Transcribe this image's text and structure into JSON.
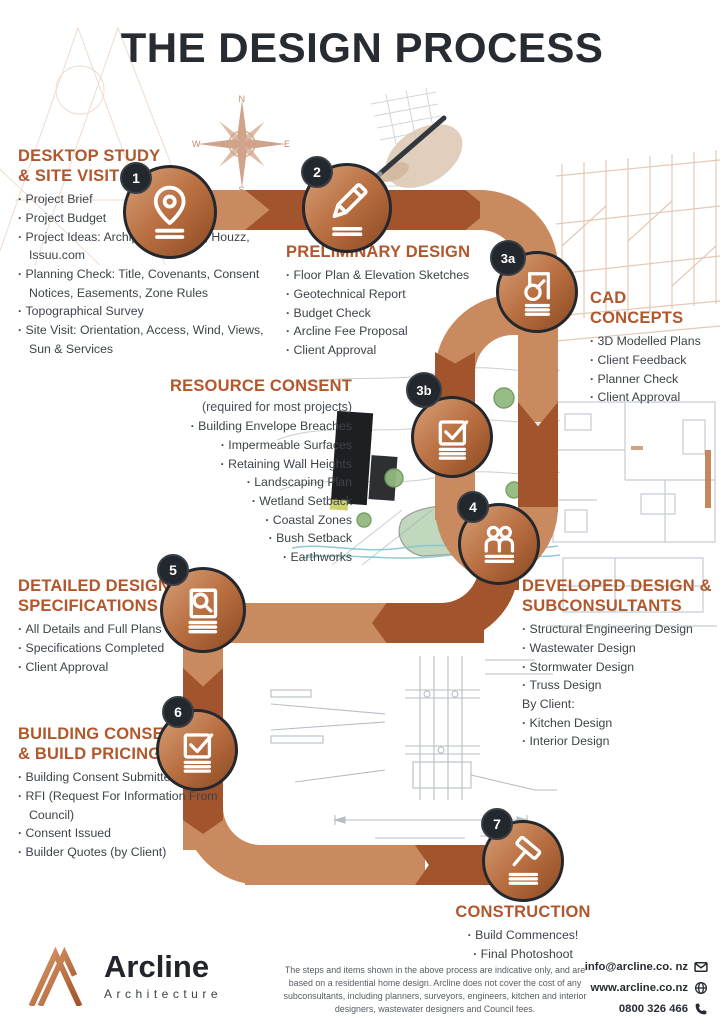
{
  "page": {
    "title": "THE DESIGN PROCESS"
  },
  "colors": {
    "accent_heading": "#b2572c",
    "path_light": "#c98a60",
    "path_dark": "#a2552c",
    "node_ring": "#23272e",
    "ink": "#272c33",
    "body_text": "#3d434b"
  },
  "compass": {
    "n": "N",
    "e": "E",
    "s": "S",
    "w": "W"
  },
  "steps": [
    {
      "number": "1",
      "icon": "location-pin-icon",
      "heading": "DESKTOP STUDY\n& SITE VISIT",
      "items": [
        "Project Brief",
        "Project Budget",
        "Project Ideas: Archipro, Pinterest, Houzz, Issuu.com",
        "Planning Check: Title, Covenants, Consent Notices, Easements, Zone Rules",
        "Topographical Survey",
        "Site Visit: Orientation, Access, Wind, Views, Sun & Services"
      ]
    },
    {
      "number": "2",
      "icon": "pencil-icon",
      "heading": "PRELIMINARY DESIGN",
      "items": [
        "Floor Plan & Elevation Sketches",
        "Geotechnical Report",
        "Budget Check",
        "Arcline Fee Proposal",
        "Client Approval"
      ]
    },
    {
      "number": "3a",
      "icon": "cad-drawing-icon",
      "heading": "CAD CONCEPTS",
      "items": [
        "3D Modelled Plans",
        "Client Feedback",
        "Planner Check",
        "Client Approval"
      ]
    },
    {
      "number": "3b",
      "icon": "checkbox-icon",
      "heading": "RESOURCE CONSENT",
      "subtitle": "(required for most projects)",
      "items": [
        "Building Envelope Breaches",
        "Impermeable Surfaces",
        "Retaining Wall Heights",
        "Landscaping Plan",
        "Wetland Setback",
        "Coastal Zones",
        "Bush Setback",
        "Earthworks"
      ]
    },
    {
      "number": "4",
      "icon": "people-icon",
      "heading": "DEVELOPED DESIGN &\nSUBCONSULTANTS",
      "items": [
        "Structural Engineering Design",
        "Wastewater Design",
        "Stormwater Design",
        "Truss Design",
        "By Client:",
        "Kitchen Design",
        "Interior Design"
      ]
    },
    {
      "number": "5",
      "icon": "document-search-icon",
      "heading": "DETAILED DESIGN &\nSPECIFICATIONS",
      "items": [
        "All Details and Full Plans Completed",
        "Specifications Completed",
        "Client Approval"
      ]
    },
    {
      "number": "6",
      "icon": "checkbox-icon",
      "heading": "BUILDING CONSENT\n& BUILD PRICING",
      "items": [
        "Building Consent Submitted",
        "RFI (Request For Information From Council)",
        "Consent Issued",
        "Builder Quotes (by Client)"
      ]
    },
    {
      "number": "7",
      "icon": "hammer-icon",
      "heading": "CONSTRUCTION",
      "items": [
        "Build Commences!",
        "Final Photoshoot"
      ]
    }
  ],
  "footer": {
    "brand": "Arcline",
    "brand_sub": "Architecture",
    "disclaimer": "The steps and items shown in the above process are indicative only, and are based on a residential home design. Arcline does not cover the cost of any subconsultants, including planners, surveyors, engineers, kitchen and interior designers, wastewater designers and Council fees.",
    "contact": {
      "email": "info@arcline.co. nz",
      "website": "www.arcline.co.nz",
      "phone": "0800 326 466"
    }
  }
}
